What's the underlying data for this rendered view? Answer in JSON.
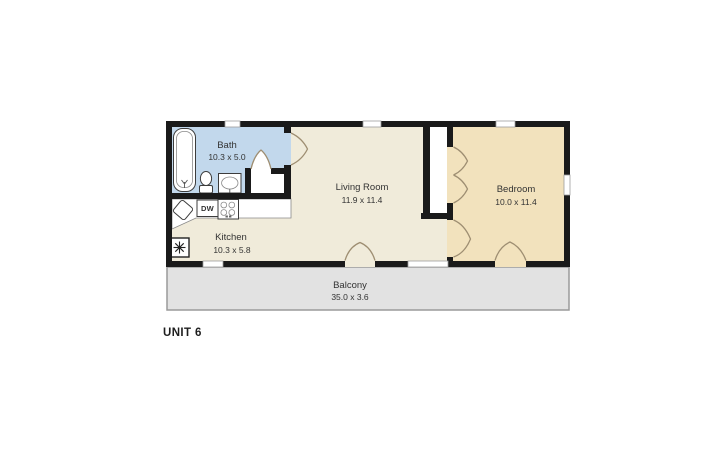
{
  "unit_label": "UNIT 6",
  "rooms": [
    {
      "name": "Bath",
      "dimensions": "10.3 x 5.0"
    },
    {
      "name": "Kitchen",
      "dimensions": "10.3 x 5.8"
    },
    {
      "name": "Living Room",
      "dimensions": "11.9 x 11.4"
    },
    {
      "name": "Bedroom",
      "dimensions": "10.0 x 11.4"
    },
    {
      "name": "Balcony",
      "dimensions": "35.0 x 3.6"
    }
  ],
  "appliances": {
    "dishwasher_label": "DW"
  },
  "icons": {
    "bathtub-icon": "rounded-rect tub outline with faucet",
    "toilet-icon": "tank + oval bowl",
    "bathroom-sink-icon": "square vanity with oval basin",
    "kitchen-sink-icon": "tilted square basin",
    "stove-icon": "square with 4 burner circles",
    "snowflake-icon": "boxed asterisk (AC/heater unit)",
    "door-swing-icon": "concave triangle door swing",
    "window-icon": "white gap in wall"
  },
  "colors": {
    "bath_fill": "#c2d8ec",
    "floor_fill": "#f0ebda",
    "bedroom_fill": "#f2e2bd",
    "balcony_fill": "#e2e2e2",
    "balcony_border": "#9a9a9a",
    "wall": "#1a1a1a",
    "door_swing": "#9e8e72",
    "label_text": "#333333"
  }
}
